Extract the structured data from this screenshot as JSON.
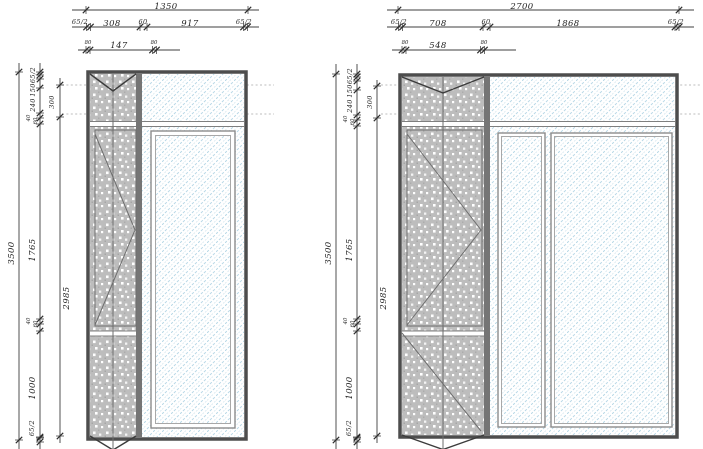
{
  "left_view": {
    "width_total": "1350",
    "width_chain": [
      "65/2",
      "308",
      "60",
      "917",
      "65/2"
    ],
    "width_detail": [
      "80",
      "147",
      "80"
    ],
    "height_total": "3500",
    "height_chain": [
      "65/2",
      "150",
      "240",
      "40",
      "60",
      "1765",
      "40",
      "60",
      "1000",
      "65/2"
    ],
    "height_inner": [
      "300",
      "2985"
    ]
  },
  "right_view": {
    "width_total": "2700",
    "width_chain": [
      "65/2",
      "708",
      "60",
      "1868",
      "65/2"
    ],
    "width_detail": [
      "80",
      "548",
      "80"
    ],
    "height_total": "3500",
    "height_chain": [
      "65/2",
      "150",
      "240",
      "40",
      "60",
      "1765",
      "40",
      "60",
      "1000",
      "65/2"
    ],
    "height_inner": [
      "300",
      "2985"
    ]
  },
  "style": {
    "glass_hatch_color": "#b7d7e6",
    "panel_fill_color": "#bdbdbd",
    "frame_color": "#4d4d4d",
    "dim_line_color": "#3f3f3f",
    "guide_dash_color": "#bcbcbc"
  }
}
